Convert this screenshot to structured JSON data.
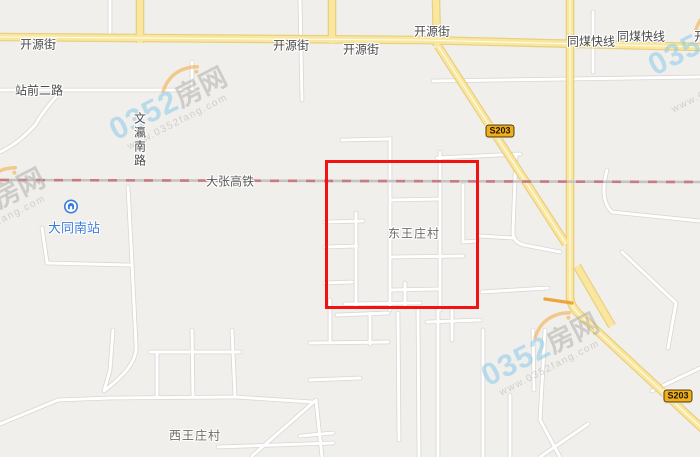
{
  "map": {
    "colors": {
      "background": "#f1efec",
      "road_major_fill": "#f9e7a0",
      "road_major_casing": "#e9cf7f",
      "road_major_centerline": "#fffdf2",
      "road_minor_fill": "#ffffff",
      "road_minor_casing": "#d9d6d2",
      "road_orange": "#f0a53c",
      "railway_base": "#c6c3c0",
      "railway_dash": "#c97b82",
      "highlight_rect": "#f11212",
      "road_label": "#4a4a4a",
      "village_label": "#6e6a64",
      "station_blue": "#3b7cdb",
      "badge_fill": "#f0ad1e",
      "badge_border": "#473a00",
      "watermark_blue": "#8ccae9",
      "watermark_gray": "#b3b0ad",
      "watermark_orange": "#f3a93f"
    },
    "labels": [
      {
        "id": "kaiyuanjie-left",
        "text": "开源街",
        "x": 38,
        "y": 44,
        "type": "road"
      },
      {
        "id": "kaiyuanjie-mid1",
        "text": "开源街",
        "x": 291,
        "y": 45,
        "type": "road"
      },
      {
        "id": "kaiyuanjie-mid2",
        "text": "开源街",
        "x": 361,
        "y": 49,
        "type": "road"
      },
      {
        "id": "kaiyuanjie-mid3",
        "text": "开源街",
        "x": 432,
        "y": 31,
        "type": "road"
      },
      {
        "id": "kaiyuanjie-right",
        "text": "开源街",
        "x": 712,
        "y": 36,
        "type": "road"
      },
      {
        "id": "tongmei-kuaixian-1",
        "text": "同煤快线",
        "x": 591,
        "y": 41,
        "type": "road"
      },
      {
        "id": "tongmei-kuaixian-2",
        "text": "同煤快线",
        "x": 641,
        "y": 36,
        "type": "road"
      },
      {
        "id": "zhanqian-erlu",
        "text": "站前二路",
        "x": 39,
        "y": 90,
        "type": "road"
      },
      {
        "id": "wenying-nanlu",
        "text": "文瀛南路",
        "x": 140,
        "y": 140,
        "type": "road-vertical"
      },
      {
        "id": "dazhang-gaotie",
        "text": "大张高铁",
        "x": 230,
        "y": 181,
        "type": "railway"
      },
      {
        "id": "dongwangzhuang-cun",
        "text": "东王庄村",
        "x": 414,
        "y": 233,
        "type": "village"
      },
      {
        "id": "xiwangzhuang-cun",
        "text": "西王庄村",
        "x": 195,
        "y": 435,
        "type": "village"
      }
    ],
    "station": {
      "name": "大同南站",
      "icon": "metro-station-icon",
      "icon_x": 71,
      "icon_y": 209,
      "label_x": 74,
      "label_y": 227
    },
    "badges": [
      {
        "id": "s203-north",
        "text": "S203",
        "x": 500,
        "y": 131
      },
      {
        "id": "s203-south",
        "text": "S203",
        "x": 678,
        "y": 396
      }
    ],
    "highlight_rect": {
      "x": 325,
      "y": 160,
      "width": 154,
      "height": 149
    },
    "railway": {
      "d": "M0,180 L700,182"
    },
    "roads": {
      "major": [
        {
          "d": "M0,37 L420,40 L700,47",
          "center": true
        },
        {
          "d": "M140,0 L140,43",
          "center": false
        },
        {
          "d": "M332,0 L332,43",
          "center": false
        },
        {
          "d": "M436,0 L437,46",
          "center": false
        },
        {
          "d": "M570,0 L570,296 Q570,306 580,315 L706,432",
          "center": true
        },
        {
          "d": "M438,46 L566,244",
          "center": true
        },
        {
          "d": "M577,266 L612,326",
          "center": false
        }
      ],
      "orange": [
        "M545,299 L572,303"
      ],
      "minor": [
        "M0,90 L196,90",
        "M192,62 L192,91",
        "M62,90 Q42,112 36,124 Q18,144 0,152",
        "M110,0 L110,39",
        "M300,0 L302,100",
        "M593,12 L593,72",
        "M433,81 L700,77",
        "M128,187 L132,264 L136,344",
        "M42,228 L47,262",
        "M47,263 L130,265",
        "M136,344 C138,362 122,377 104,391",
        "M113,330 L110,370 L104,391",
        "M0,424 L58,400 L110,398",
        "M110,398 L235,397",
        "M150,352 L240,352",
        "M157,352 L157,397",
        "M192,330 L193,397",
        "M232,330 L235,397",
        "M235,397 L312,402",
        "M252,456 L316,400 L322,457",
        "M218,447 L333,443",
        "M390,138 L390,310",
        "M342,140 L390,139",
        "M437,158 L520,154",
        "M440,152 L440,310",
        "M463,185 L463,242 L478,241",
        "M390,200 L440,199",
        "M390,257 L463,256",
        "M356,213 L356,307",
        "M325,222 L363,221",
        "M325,247 L357,246",
        "M325,283 L352,282",
        "M345,304 L420,303",
        "M405,283 L405,307",
        "M390,290 L438,289",
        "M516,154 L513,230 Q512,242 524,245 L560,252",
        "M479,236 L513,238",
        "M482,292 L548,288",
        "M607,170 Q599,200 612,212 L700,221",
        "M622,252 L676,303 L668,348",
        "M700,368 L652,391",
        "M330,300 L330,343",
        "M310,343 L388,342",
        "M370,313 L370,344",
        "M337,315 L388,313",
        "M398,313 L399,440",
        "M418,310 L419,457",
        "M438,310 L438,457",
        "M452,310 L452,340",
        "M427,322 L480,320",
        "M310,380 L360,378",
        "M300,436 L333,433",
        "M483,330 L483,457",
        "M510,395 L510,457",
        "M533,330 L534,390",
        "M545,330 L540,420",
        "M540,420 L560,457",
        "M540,457 L588,424"
      ]
    },
    "watermark": {
      "number": "0352",
      "name": "房网",
      "url": "www.0352fang.com",
      "instances": [
        {
          "x": 168,
          "y": 103,
          "rotation": -27
        },
        {
          "x": 540,
          "y": 349,
          "rotation": -27
        },
        {
          "x": 706,
          "y": 54,
          "rotation": -27
        },
        {
          "x": -14,
          "y": 204,
          "rotation": -27
        }
      ]
    }
  }
}
